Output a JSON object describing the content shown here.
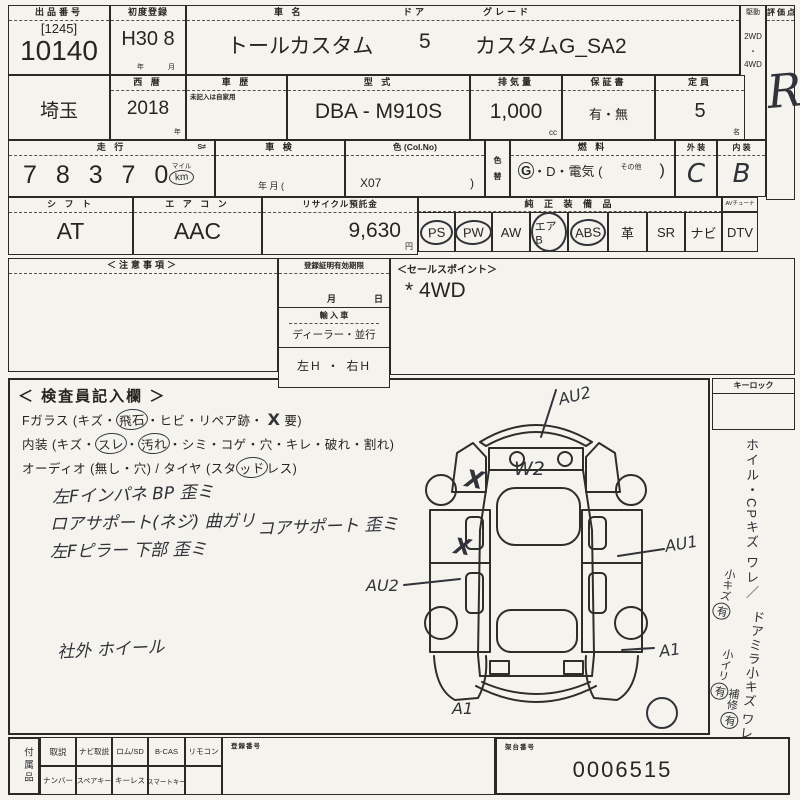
{
  "row1": {
    "lot_label": "出品番号",
    "lot_bracket": "[1245]",
    "lot_number": "10140",
    "reg_label": "初度登録",
    "reg_value": "H30 8",
    "reg_year_unit": "年",
    "reg_month_unit": "月",
    "name_label": "車  名",
    "name_value": "トールカスタム",
    "door_label": "ドア",
    "door_value": "5",
    "grade_label": "グレード",
    "grade_value": "カスタムG_SA2",
    "drive_label": "駆動",
    "drive_2wd": "2WD",
    "drive_dot": "・",
    "drive_4wd": "4WD",
    "score_label": "評価点",
    "score_value": "R"
  },
  "row2": {
    "prefecture": "埼玉",
    "year_label": "西  暦",
    "year_value": "2018",
    "year_unit": "年",
    "history_label": "車  歴",
    "history_note": "未記入は自家用",
    "model_label": "型  式",
    "model_value": "DBA - M910S",
    "disp_label": "排気量",
    "disp_value": "1,000",
    "disp_unit": "cc",
    "warranty_label": "保証書",
    "warranty_value": "有・無",
    "capacity_label": "定員",
    "capacity_value": "5",
    "capacity_unit": "名"
  },
  "row3": {
    "mileage_label": "走  行",
    "mileage_flag": "S≠",
    "mileage_value": "7 8  3 7 0",
    "mileage_mile": "マイル",
    "mileage_km": "km",
    "inspection_label": "車  検",
    "inspection_units": "年          月 (",
    "color_label": "色 (Col.No)",
    "color_value": "X07",
    "color_close": ")",
    "color_change_top": "色",
    "color_change_bottom": "替",
    "fuel_label": "燃  料",
    "fuel_g": "G",
    "fuel_rest": "・D・電気 (",
    "fuel_other": "その他",
    "fuel_close": ")",
    "exterior_label": "外 装",
    "exterior_value": "C",
    "interior_label": "内 装",
    "interior_value": "B"
  },
  "row4": {
    "shift_label": "シ フ ト",
    "shift_value": "AT",
    "ac_label": "エ ア コ ン",
    "ac_value": "AAC",
    "recycle_label": "リサイクル預託金",
    "recycle_value": "9,630",
    "recycle_unit": "円",
    "equip_label": "純 正 装 備 品",
    "tuner_label": "AVチューナー無",
    "equipment": [
      {
        "label": "PS",
        "circled": true
      },
      {
        "label": "PW",
        "circled": true
      },
      {
        "label": "AW",
        "circled": false
      },
      {
        "label": "エアB",
        "circled": true
      },
      {
        "label": "ABS",
        "circled": true
      },
      {
        "label": "革",
        "circled": false
      },
      {
        "label": "SR",
        "circled": false
      },
      {
        "label": "ナビ",
        "circled": false
      },
      {
        "label": "DTV",
        "circled": false
      }
    ]
  },
  "mid": {
    "notes_label": "＜注意事項＞",
    "reg_label": "登録証明有効期限",
    "reg_month": "月",
    "reg_day": "日",
    "import_label": "輸 入 車",
    "import_value": "ディーラー・並行",
    "handle_value": "左H ・ 右H",
    "sales_label": "＜セールスポイント＞",
    "sales_value": "* 4WD"
  },
  "inspector": {
    "title": "＜ 検査員記入欄 ＞",
    "glass": [
      "Fガラス (キズ・",
      "飛石",
      "・ヒビ・リペア跡・",
      "X",
      "要)"
    ],
    "interior": [
      "内装 (キズ・",
      "スレ",
      "・",
      "汚れ",
      "・シミ・コゲ・穴・キレ・破れ・割れ)"
    ],
    "audio": [
      "オーディオ (無し・穴) / タイヤ (スタ",
      "ッド",
      "レス)"
    ],
    "notes": [
      "左Fインパネ BP 歪ミ",
      "ロアサポート(ネジ) 曲ガリ",
      "コアサポート 歪ミ",
      "左Fピラー 下部 歪ミ",
      "社外 ホイール"
    ]
  },
  "diagram": {
    "front_mark": "AU2",
    "windshield_mark": "W2",
    "right_mark": "AU1",
    "left_mark": "AU2",
    "right_rear_mark": "A1",
    "rear_mark": "A1",
    "x_mark_1": "X",
    "x_mark_2": "X"
  },
  "right_col": {
    "keylock_label": "キーロック",
    "note1": "ホイル・CPキズ ワレ／",
    "note1_sub": "小キズ",
    "note1_circle": "有",
    "note2": "ドアミラ小キズ ワレ",
    "note2_sub": "小イリ",
    "note2_circle": "有",
    "note3_sub": "補修",
    "note3_circle": "有"
  },
  "bottom": {
    "acc_label": "付属品",
    "row_top": [
      "取説",
      "ナビ取説",
      "ロム/SD",
      "B-CAS",
      "リモコン"
    ],
    "row_bottom": [
      "ナンバー",
      "スペアキー",
      "キーレス",
      "スマートキー",
      ""
    ],
    "mid_label": "登録番号",
    "serial_label": "架台番号",
    "serial_value": "0006515"
  }
}
